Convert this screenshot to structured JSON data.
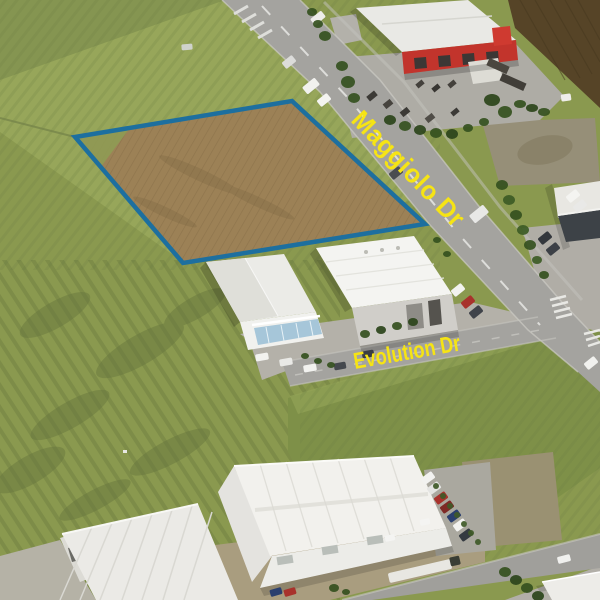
{
  "meta": {
    "description": "Oblique aerial photograph of an industrial estate with a vacant land allotment outlined in blue",
    "width_px": 600,
    "height_px": 600
  },
  "annotations": {
    "parcel_outline": {
      "name": "highlighted-allotment",
      "color": "#1d6f9f",
      "stroke_width": 4.5,
      "points": "75,137 292,101 425,224 183,263"
    },
    "street_labels": [
      {
        "text": "Maggiolo Dr",
        "color": "#f6e414",
        "rotation_deg": 46
      },
      {
        "text": "Evolution Dr",
        "color": "#f6e414",
        "rotation_deg": -10
      }
    ]
  },
  "scene": {
    "colors": {
      "grass_base": "#8a994f",
      "grass_light": "#97a65a",
      "grass_hill": "#7e9048",
      "scrub_dark": "#66753d",
      "parcel_dirt": "#9c8156",
      "ploughed_field": "#564427",
      "road": "#a4a39f",
      "concrete": "#b4b1a9",
      "roof_white": "#f4f4f1",
      "wall_red": "#c2342c",
      "wall_gray": "#d0cec9",
      "office_glass": "#a6c6d9"
    },
    "features": [
      "grass-paddocks",
      "vacant-dirt-allotment",
      "maggiolo-drive",
      "evolution-drive",
      "red-roofed-trade-building",
      "equipment-yard",
      "ploughed-field",
      "mid-left-warehouse-with-glass-office",
      "mid-right-warehouse",
      "right-edge-showroom",
      "bottom-left-warehouse",
      "bottom-centre-warehouse",
      "bottom-right-road",
      "semi-trailer-truck",
      "parked-cars",
      "street-trees-and-hedges",
      "road-markings"
    ]
  }
}
